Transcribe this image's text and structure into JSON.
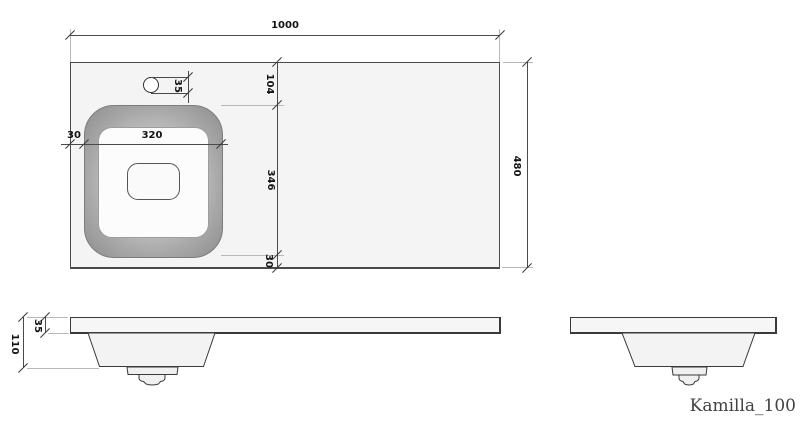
{
  "title": "Kamilla_100",
  "dimensions": {
    "overall_width": "1000",
    "overall_depth": "480",
    "basin_offset_top": "104",
    "basin_length": "346",
    "basin_offset_bottom": "30",
    "basin_offset_left": "30",
    "basin_width": "320",
    "faucet_hole_diameter": "35",
    "countertop_thickness": "35",
    "total_height": "110"
  },
  "colors": {
    "line": "#4a4a4a",
    "extension_line": "#b8b8b8",
    "panel_fill": "#f4f4f4",
    "basin_rim": "#a8a8a8",
    "basin_inner": "#fcfcfc"
  }
}
